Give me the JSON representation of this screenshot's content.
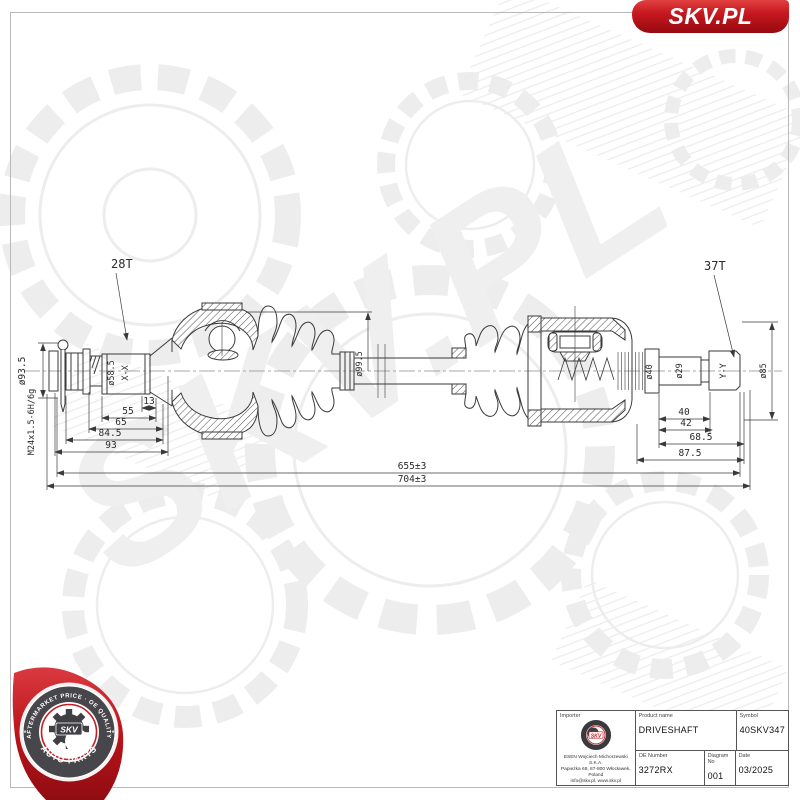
{
  "banner": {
    "brand": "SKV.PL"
  },
  "drawing": {
    "labels": {
      "left_spline_teeth": "28T",
      "right_spline_teeth": "37T"
    },
    "dims": {
      "flange_dia": "ø93.5",
      "thread": "M24x1.5-6H/6g",
      "left_spline_dia": "ø58.5",
      "left_section": "X-X",
      "d13": "13",
      "d55": "55",
      "d65": "65",
      "d845": "84.5",
      "d93": "93",
      "boot_dia": "ø99.5",
      "d40dia": "ø40",
      "d29dia": "ø29",
      "right_section": "Y-Y",
      "d85dia": "ø85",
      "d40": "40",
      "d42": "42",
      "d685": "68.5",
      "d875": "87.5",
      "len_inner": "655±3",
      "len_total": "704±3"
    }
  },
  "stamp": {
    "top_text": "AFTERMARKET PRICE · OE QUALITY",
    "bottom_text": "AUTO PARTS",
    "brand": "SKV",
    "star_left": "*",
    "star_right": "*"
  },
  "titleblock": {
    "importer_label": "Importer",
    "importer_name": "ESEN Wojciech Michorzewski S.K.A.",
    "importer_address": "Papieżka 69, 87-800 Włocławek,  Poland",
    "importer_contact": "info@skv.pl, www.skv.pl",
    "product_label": "Product name",
    "product": "DRIVESHAFT",
    "symbol_label": "Symbol",
    "symbol": "40SKV347",
    "oe_label": "OE Number",
    "oe": "3272RX",
    "diagram_label": "Diagram No",
    "diagram": "001",
    "date_label": "Date",
    "date": "03/2025",
    "mini_brand": "SKV"
  },
  "colors": {
    "accent_red": "#c41e22",
    "line": "#3a3a3a",
    "watermark": "#ededed"
  }
}
